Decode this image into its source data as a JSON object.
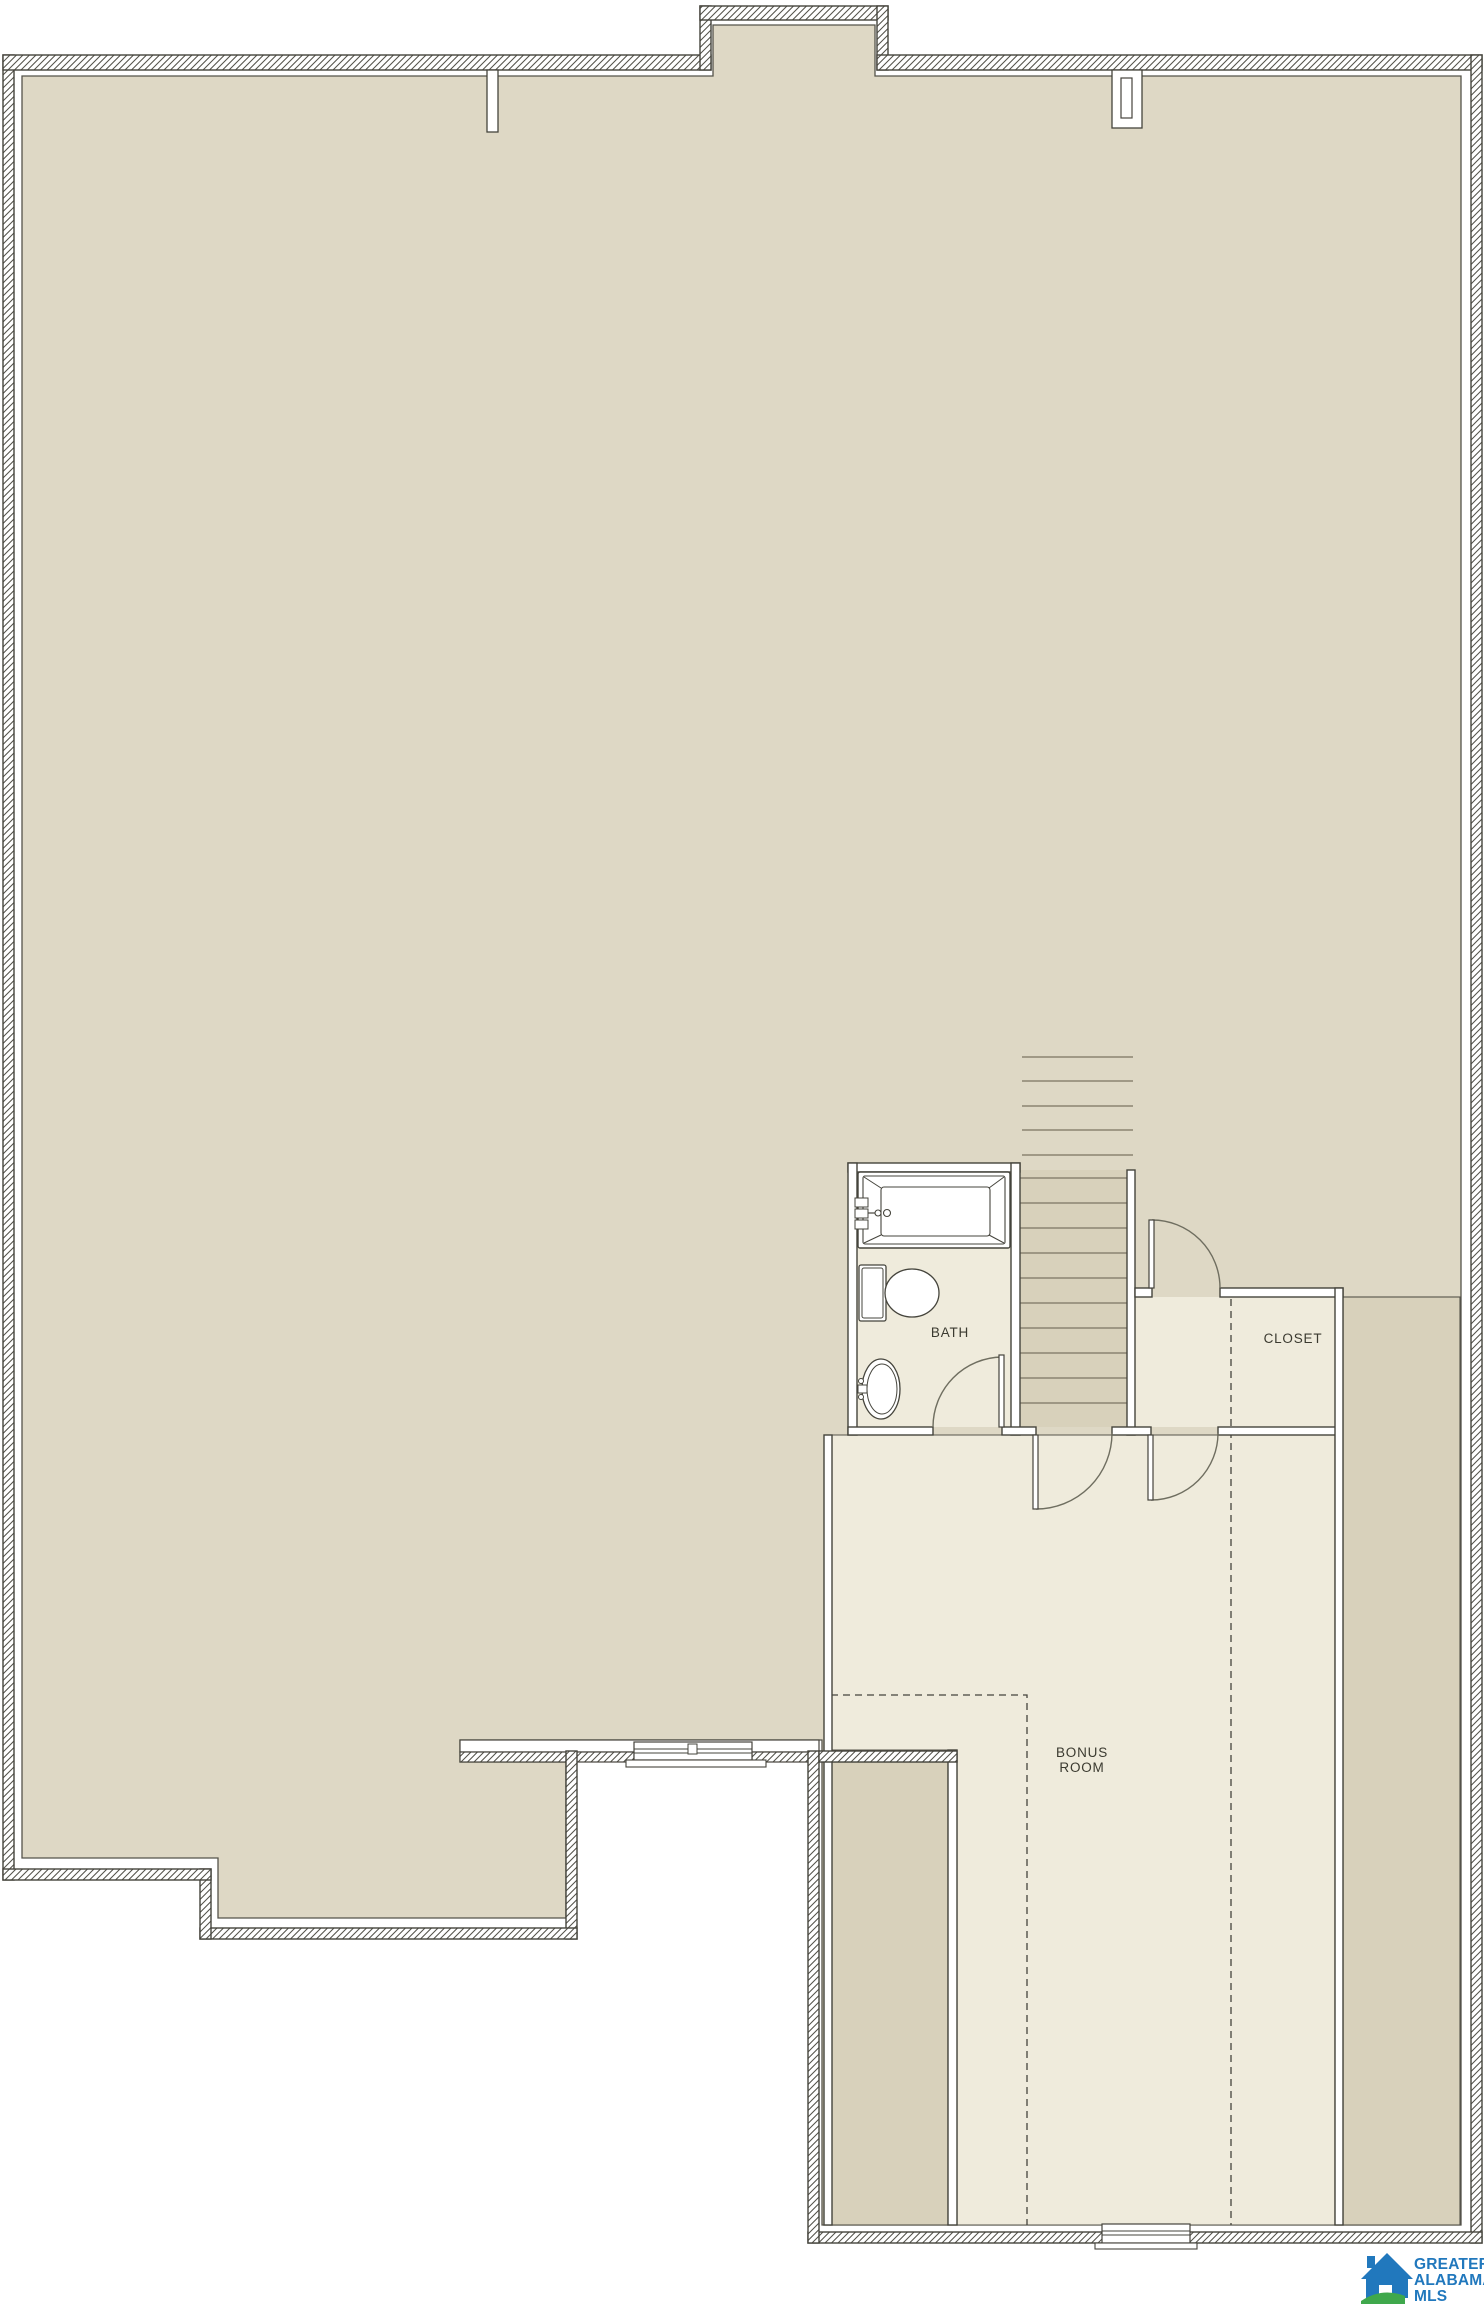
{
  "page": {
    "background": "#ffffff",
    "document_type": "second floor plan drawing"
  },
  "floorplan": {
    "labels": {
      "bath": "BATH",
      "closet": "CLOSET",
      "bonus_line1": "BONUS",
      "bonus_line2": "ROOM"
    },
    "colors": {
      "attic_fill": "#ded8c5",
      "room_fill": "#efebdc",
      "stair_column_fill": "#d8d1bb",
      "wall_outline": "#45443c",
      "hatch_line": "#53524a",
      "tread_line": "#8b8472",
      "door_arc": "#6f6e60",
      "label_text": "#3b3a30"
    }
  },
  "logo": {
    "line1": "GREATER",
    "line2": "ALABAMA",
    "line3": "MLS",
    "blue": "#2178bd",
    "green": "#3fa84c"
  }
}
